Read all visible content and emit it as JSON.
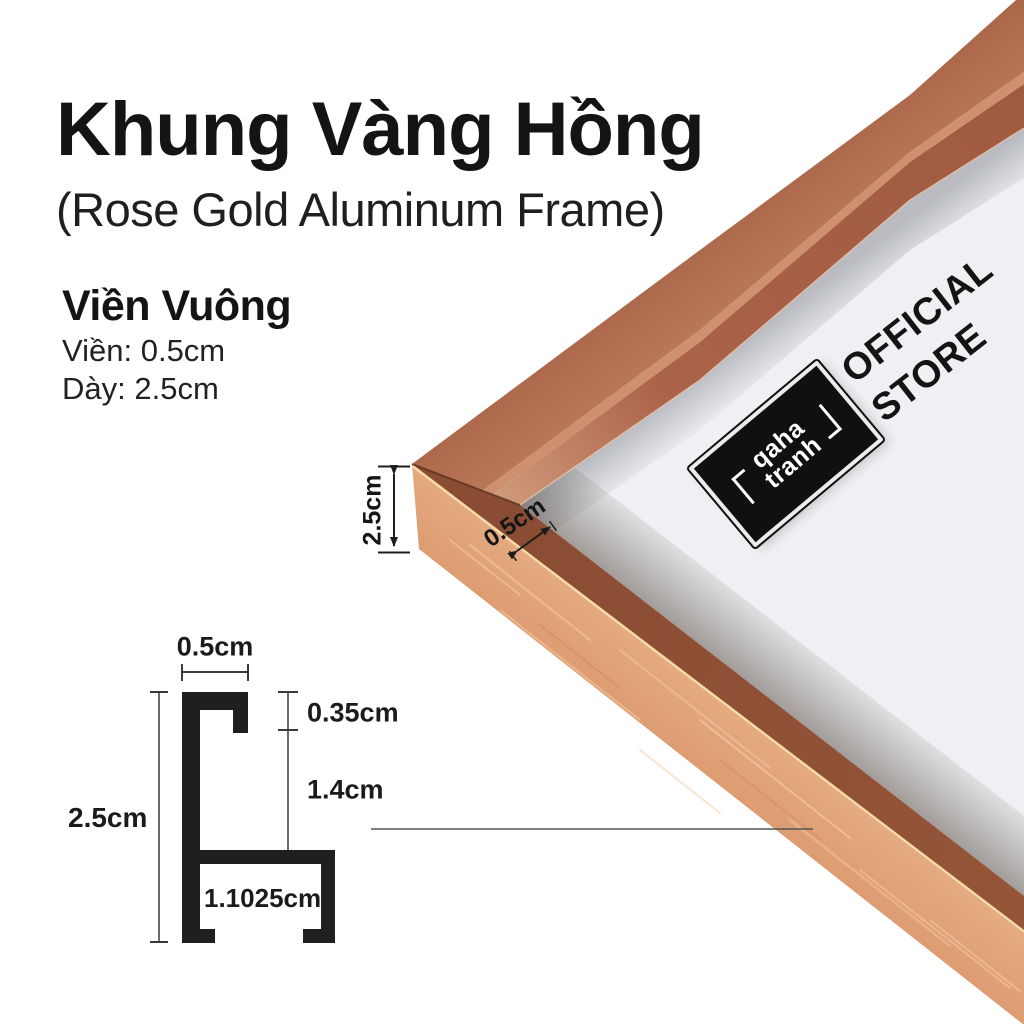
{
  "page": {
    "background": "#ffffff"
  },
  "header": {
    "title": "Khung Vàng Hồng",
    "subtitle": "(Rose Gold Aluminum Frame)"
  },
  "specs": {
    "heading": "Viền Vuông",
    "border": "Viền: 0.5cm",
    "thickness": "Dày: 2.5cm"
  },
  "photo": {
    "thickness_label": "2.5cm",
    "border_label": "0.5cm",
    "badge": {
      "line1": "qaha",
      "line2": "tranh"
    },
    "official_store": {
      "line1": "OFFICIAL",
      "line2": "STORE"
    },
    "colors": {
      "frame_side": "#e2a47f",
      "frame_top": "#8f5137",
      "frame_outer": "#b4715a",
      "gold_ridge": "#f6dca8",
      "mat": "#eef0f3"
    }
  },
  "diagram": {
    "top_width": "0.5cm",
    "lip_height": "0.35cm",
    "inner_height": "1.4cm",
    "total_height": "2.5cm",
    "bottom_width": "1.1025cm"
  }
}
